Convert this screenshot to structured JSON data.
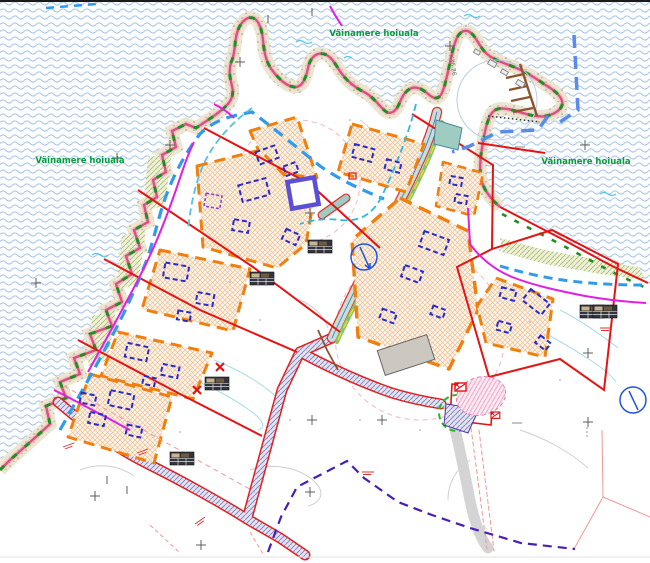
{
  "map": {
    "labels": {
      "protected_area": "Väinamere hoiuala",
      "pier_code": "K36-26"
    },
    "colors": {
      "protected_area_text": "#089b40",
      "coastline": "#d9527a",
      "coast_green_dash": "#1f8f1f",
      "parcel_boundary": "#e41414",
      "building_zone": "#f07f0e",
      "planned_building": "#2a2ac8",
      "retained_building": "#5b4fd6",
      "shore_buffer_dash": "#2f9bea",
      "harbor_boundary": "#5b8bea",
      "utility_magenta": "#e020e0",
      "pier_brown": "#8a5530",
      "zigzag_purple": "#4a1fb8",
      "sea_wave": "#aac4e2"
    }
  }
}
